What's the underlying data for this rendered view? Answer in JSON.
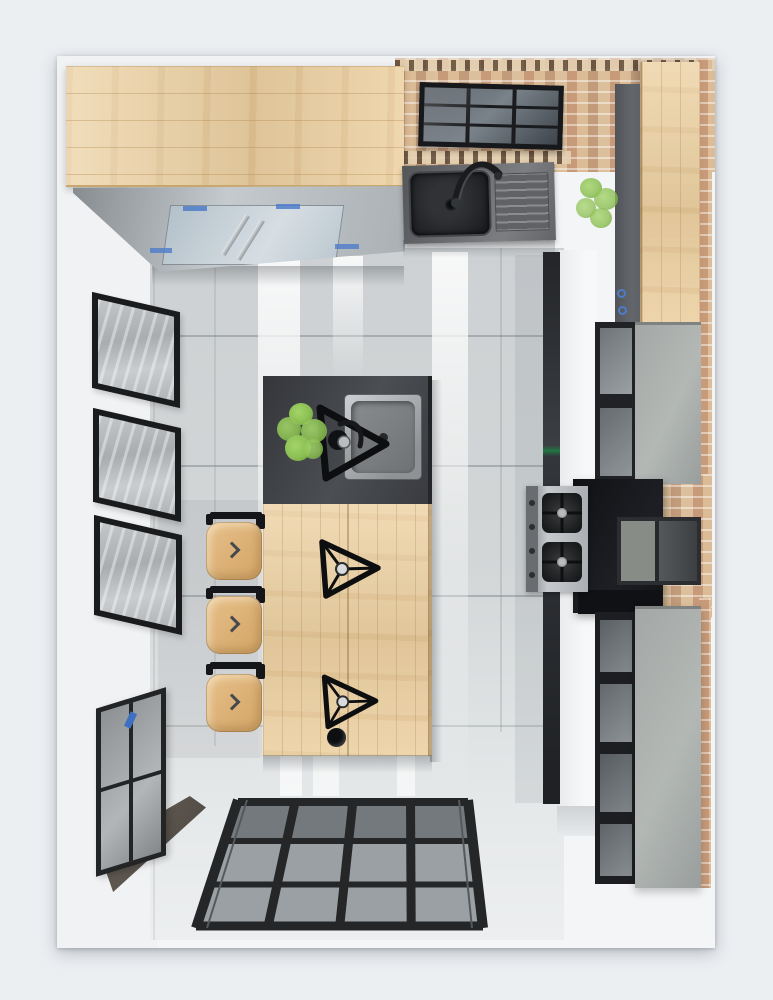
{
  "meta": {
    "content_type": "photorealistic 3d render",
    "view": "top-down bird's-eye",
    "subject": "kitchen interior with island"
  },
  "palette": {
    "matte": "#eceff2",
    "photo_bg": "#f4f5f6",
    "wall": "#f1f2f4",
    "floor": "#d2d6d7",
    "floor_light": "#e6e9ea",
    "wood": "#ecd0a1",
    "wood_deep": "#d9b77f",
    "brick_base": "#d8bd9b",
    "brick_red": "#c08063",
    "charcoal": "#3e4045",
    "black": "#1a1b1e",
    "steel": "#bfc3c5",
    "steel_deep": "#85898c",
    "glass": "#9aa0a3",
    "glass_blue": "#bcc8d2",
    "concrete": "#a3a8a6",
    "hood": "#141519",
    "green": "#8cbf54",
    "green_deep": "#689e38",
    "blue_accent": "#4f7cc9",
    "stool_wood": "#e6c08a",
    "art_gray": "#bfc3c5"
  },
  "objects": [
    {
      "name": "top-wood-countertop",
      "material": "wood"
    },
    {
      "name": "upper-glass-cabinets",
      "material": "glass_blue"
    },
    {
      "name": "skylight-window",
      "material": "glass"
    },
    {
      "name": "brick-wall",
      "material": "brick_base"
    },
    {
      "name": "wall-sink-unit",
      "material": "charcoal"
    },
    {
      "name": "wall-plant",
      "material": "green"
    },
    {
      "name": "right-wood-counter",
      "material": "wood"
    },
    {
      "name": "tall-display-cabinet-upper",
      "material": "concrete"
    },
    {
      "name": "range-hood",
      "material": "hood"
    },
    {
      "name": "gas-cooktop",
      "material": "steel"
    },
    {
      "name": "tall-display-cabinet-lower",
      "material": "concrete"
    },
    {
      "name": "kitchen-island-counter",
      "material": "charcoal"
    },
    {
      "name": "island-sink",
      "material": "steel"
    },
    {
      "name": "island-faucet",
      "material": "black"
    },
    {
      "name": "island-plant",
      "material": "green"
    },
    {
      "name": "island-wood-table",
      "material": "wood"
    },
    {
      "name": "pendant-lamp-1",
      "material": "black"
    },
    {
      "name": "pendant-lamp-2",
      "material": "black"
    },
    {
      "name": "bar-stool-1",
      "material": "stool_wood"
    },
    {
      "name": "bar-stool-2",
      "material": "stool_wood"
    },
    {
      "name": "bar-stool-3",
      "material": "stool_wood"
    },
    {
      "name": "wall-art-frame-1",
      "material": "art_gray"
    },
    {
      "name": "wall-art-frame-2",
      "material": "art_gray"
    },
    {
      "name": "wall-art-frame-3",
      "material": "art_gray"
    },
    {
      "name": "left-window",
      "material": "glass"
    },
    {
      "name": "glazed-partition-doors",
      "material": "glass"
    }
  ]
}
